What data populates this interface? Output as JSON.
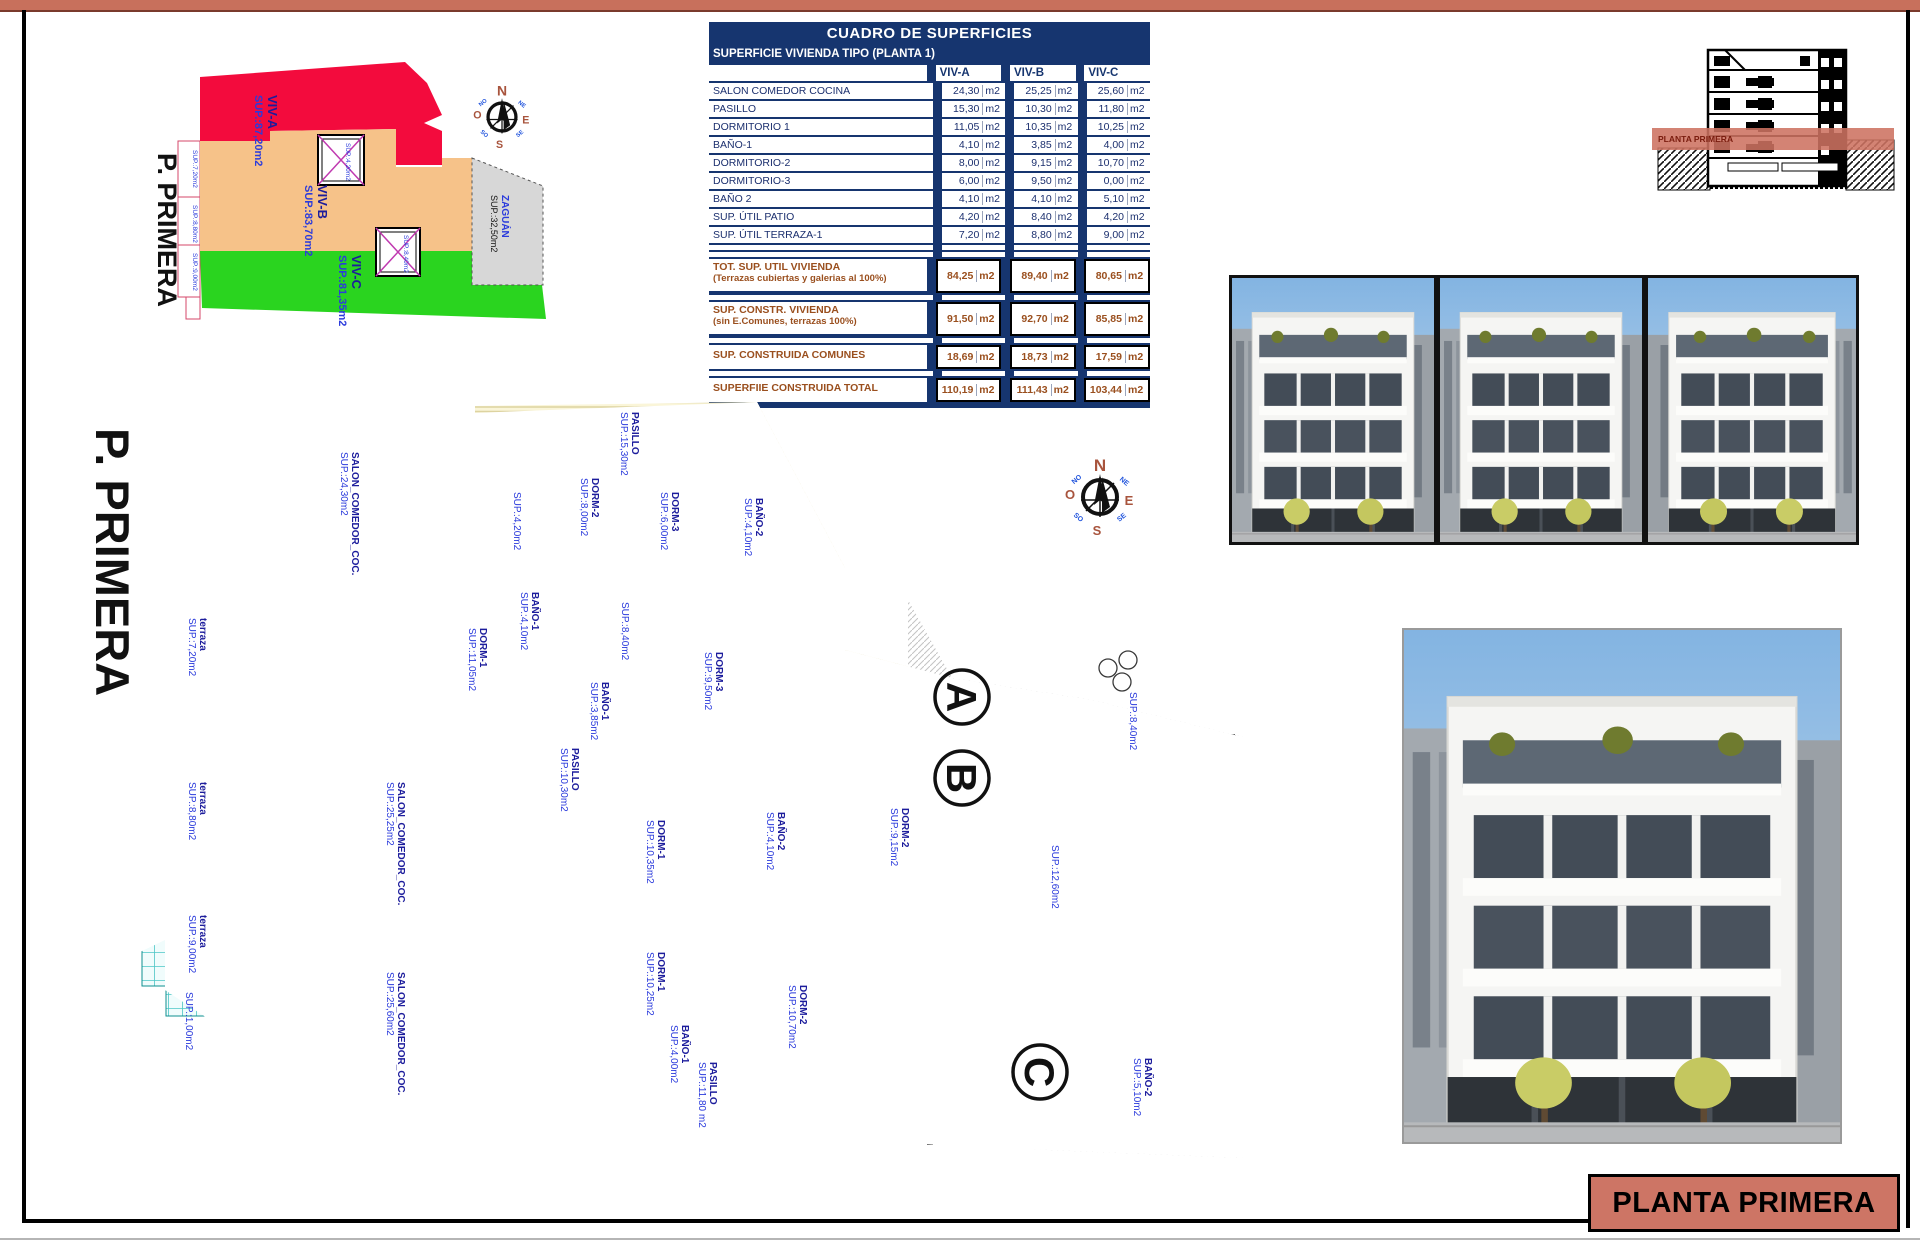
{
  "page": {
    "title_block": "PLANTA PRIMERA"
  },
  "zone_diagram": {
    "floor_label": "P. PRIMERA",
    "zones": [
      {
        "name": "VIV-A",
        "sup": "SUP.:87,20m2",
        "color": "#f30b3d"
      },
      {
        "name": "VIV-B",
        "sup": "SUP.:83,70m2",
        "color": "#f6c289"
      },
      {
        "name": "VIV-C",
        "sup": "SUP.:81,35m2",
        "color": "#2ad41f"
      },
      {
        "name": "ZAGUÁN",
        "sup": "SUP.:32,50m2",
        "color": "#d7d7d7"
      }
    ],
    "side_labels": [
      "SUP.:7,20m2",
      "SUP.:8,80m2",
      "SUP.:9,00m2"
    ],
    "patio_labels": [
      "SUP.:4,20m2",
      "SUP.:8,40m2"
    ]
  },
  "compass": {
    "n": "N",
    "s": "S",
    "e": "E",
    "o": "O",
    "ne": "NE",
    "no": "NO",
    "se": "SE",
    "so": "SO"
  },
  "table": {
    "title": "CUADRO DE SUPERFICIES",
    "subtitle": "SUPERFICIE VIVIENDA TIPO  (PLANTA 1)",
    "columns": [
      "VIV-A",
      "VIV-B",
      "VIV-C"
    ],
    "unit": "m2",
    "rows": [
      {
        "label": "SALON COMEDOR COCINA",
        "values": [
          "24,30",
          "25,25",
          "25,60"
        ]
      },
      {
        "label": "PASILLO",
        "values": [
          "15,30",
          "10,30",
          "11,80"
        ]
      },
      {
        "label": "DORMITORIO 1",
        "values": [
          "11,05",
          "10,35",
          "10,25"
        ]
      },
      {
        "label": "BAÑO-1",
        "values": [
          "4,10",
          "3,85",
          "4,00"
        ]
      },
      {
        "label": "DORMITORIO-2",
        "values": [
          "8,00",
          "9,15",
          "10,70"
        ]
      },
      {
        "label": "DORMITORIO-3",
        "values": [
          "6,00",
          "9,50",
          "0,00"
        ]
      },
      {
        "label": "BAÑO 2",
        "values": [
          "4,10",
          "4,10",
          "5,10"
        ]
      },
      {
        "label": "SUP. ÚTIL PATIO",
        "values": [
          "4,20",
          "8,40",
          "4,20"
        ]
      },
      {
        "label": "SUP. ÚTIL TERRAZA-1",
        "values": [
          "7,20",
          "8,80",
          "9,00"
        ]
      }
    ],
    "totals": [
      {
        "label": "TOT. SUP. UTIL VIVIENDA",
        "sublabel": "(Terrazas cubiertas y galerias al 100%)",
        "values": [
          "84,25",
          "89,40",
          "80,65"
        ]
      },
      {
        "label": "SUP. CONSTR. VIVIENDA",
        "sublabel": "(sin E.Comunes, terrazas 100%)",
        "values": [
          "91,50",
          "92,70",
          "85,85"
        ]
      },
      {
        "label": "SUP. CONSTRUIDA COMUNES",
        "sublabel": "",
        "values": [
          "18,69",
          "18,73",
          "17,59"
        ]
      },
      {
        "label": "SUPERFIIE CONSTRUIDA TOTAL",
        "sublabel": "",
        "values": [
          "110,19",
          "111,43",
          "103,44"
        ]
      }
    ]
  },
  "section_drawing": {
    "band_label": "PLANTA PRIMERA"
  },
  "floor_plan": {
    "floor_label": "P. PRIMERA",
    "unit_markers": [
      "A",
      "B",
      "C"
    ],
    "labels": [
      {
        "name": "SALON_COMEDOR_COC.",
        "sup": "SUP.:24,30m2",
        "x": 352,
        "y": 452
      },
      {
        "name": "PASILLO",
        "sup": "SUP.:15,30m2",
        "x": 632,
        "y": 412
      },
      {
        "name": "DORM-2",
        "sup": "SUP.:8,00m2",
        "x": 592,
        "y": 478
      },
      {
        "name": "DORM-3",
        "sup": "SUP.:6,00m2",
        "x": 672,
        "y": 492
      },
      {
        "name": "BAÑO-2",
        "sup": "SUP.:4,10m2",
        "x": 756,
        "y": 498
      },
      {
        "name": "BAÑO-1",
        "sup": "SUP.:4,10m2",
        "x": 532,
        "y": 592
      },
      {
        "name": "DORM-1",
        "sup": "SUP.:11,05m2",
        "x": 480,
        "y": 628
      },
      {
        "name": "terraza",
        "sup": "SUP.:7,20m2",
        "x": 200,
        "y": 618
      },
      {
        "name": "",
        "sup": "SUP.:4,20m2",
        "x": 514,
        "y": 492
      },
      {
        "name": "",
        "sup": "SUP.:8,40m2",
        "x": 622,
        "y": 602
      },
      {
        "name": "SALON_COMEDOR_COC.",
        "sup": "SUP.:25,25m2",
        "x": 398,
        "y": 782
      },
      {
        "name": "PASILLO",
        "sup": "SUP.:10,30m2",
        "x": 572,
        "y": 748
      },
      {
        "name": "DORM-3",
        "sup": "SUP.:9,50m2",
        "x": 716,
        "y": 652
      },
      {
        "name": "BAÑO-1",
        "sup": "SUP.:3,85m2",
        "x": 602,
        "y": 682
      },
      {
        "name": "DORM-1",
        "sup": "SUP.:10,35m2",
        "x": 658,
        "y": 820
      },
      {
        "name": "BAÑO-2",
        "sup": "SUP.:4,10m2",
        "x": 778,
        "y": 812
      },
      {
        "name": "DORM-2",
        "sup": "SUP.:9,15m2",
        "x": 902,
        "y": 808
      },
      {
        "name": "terraza",
        "sup": "SUP.:8,80m2",
        "x": 200,
        "y": 782
      },
      {
        "name": "SALON_COMEDOR_COC.",
        "sup": "SUP.:25,60m2",
        "x": 398,
        "y": 972
      },
      {
        "name": "DORM-1",
        "sup": "SUP.:10,25m2",
        "x": 658,
        "y": 952
      },
      {
        "name": "BAÑO-1",
        "sup": "SUP.:4,00m2",
        "x": 682,
        "y": 1025
      },
      {
        "name": "DORM-2",
        "sup": "SUP.:10,70m2",
        "x": 800,
        "y": 985
      },
      {
        "name": "PASILLO",
        "sup": "SUP.:11,80 m2",
        "x": 710,
        "y": 1062
      },
      {
        "name": "terraza",
        "sup": "SUP.:9,00m2",
        "x": 200,
        "y": 915
      },
      {
        "name": "",
        "sup": "SUP.:12,60m2",
        "x": 1052,
        "y": 845
      },
      {
        "name": "",
        "sup": "SUP.:8,40m2",
        "x": 1130,
        "y": 692
      },
      {
        "name": "BAÑO-2",
        "sup": "SUP.:5,10m2",
        "x": 1145,
        "y": 1058
      },
      {
        "name": "",
        "sup": "SUP.:1,00m2",
        "x": 186,
        "y": 992
      }
    ]
  }
}
